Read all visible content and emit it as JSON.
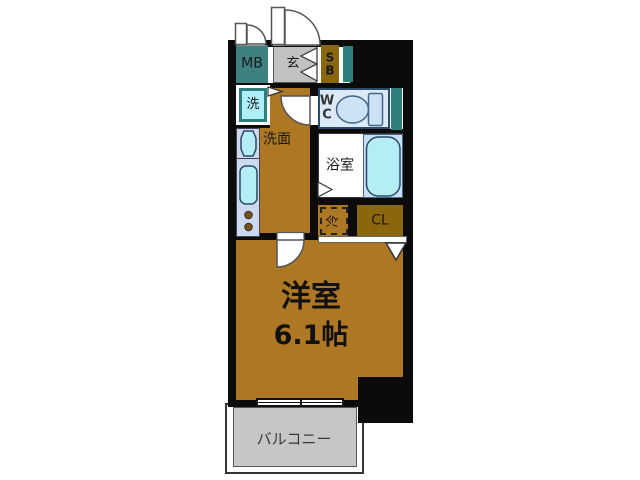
{
  "floorplan": {
    "labels": {
      "meter_box": "MB",
      "entrance": "玄",
      "shoe_box": "S\nB",
      "washing_machine": "洗",
      "washroom": "洗面",
      "toilet_room": "W\nC",
      "bathroom": "浴室",
      "refrigerator": "冷",
      "closet": "CL",
      "main_room_name": "洋室",
      "main_room_size": "6.1帖",
      "balcony": "バルコニー"
    },
    "colors": {
      "wall": "#0b0b0b",
      "floor_brown": "#ad7723",
      "unit_gold": "#8a660f",
      "pipe_space_teal": "#2e7f7b",
      "meter_box_teal": "#3e8180",
      "fixture_cyan": "#b5edf5",
      "kitchen_counter_blue": "#ccd9ef",
      "wc_floor_blue": "#dce9f7",
      "tub_panel_blue": "#c9dff3",
      "entrance_gray": "#c2c2c2",
      "balcony_gray": "#c6c6c6"
    }
  }
}
